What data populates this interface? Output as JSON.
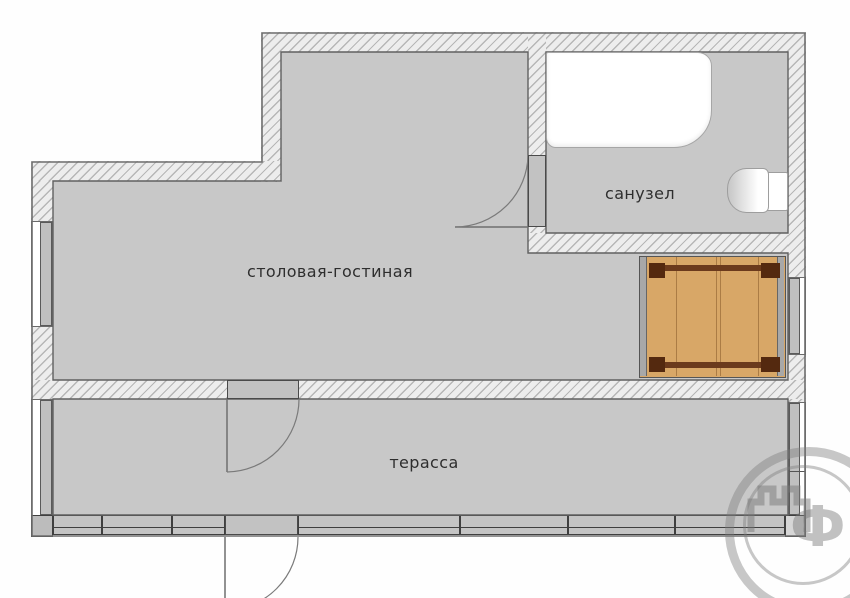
{
  "rooms": [
    {
      "name": "living-room",
      "label": "столовая-гостиная"
    },
    {
      "name": "bathroom",
      "label": "санузел"
    },
    {
      "name": "terrace",
      "label": "терасса"
    }
  ],
  "fixtures": [
    "bathtub",
    "toilet",
    "wood-table"
  ],
  "watermark": {
    "letter": "Ф"
  },
  "colors": {
    "floor": "#c8c8c8",
    "wall_hatch_bg": "#ededed",
    "wall_hatch_line": "#b6b6b6",
    "wall_outline": "#666666",
    "panel": "#c4c4c4",
    "wood": "#d8a767",
    "wood_line": "#ab7c45",
    "wood_dark": "#54290f",
    "text": "#2e2e2e"
  }
}
